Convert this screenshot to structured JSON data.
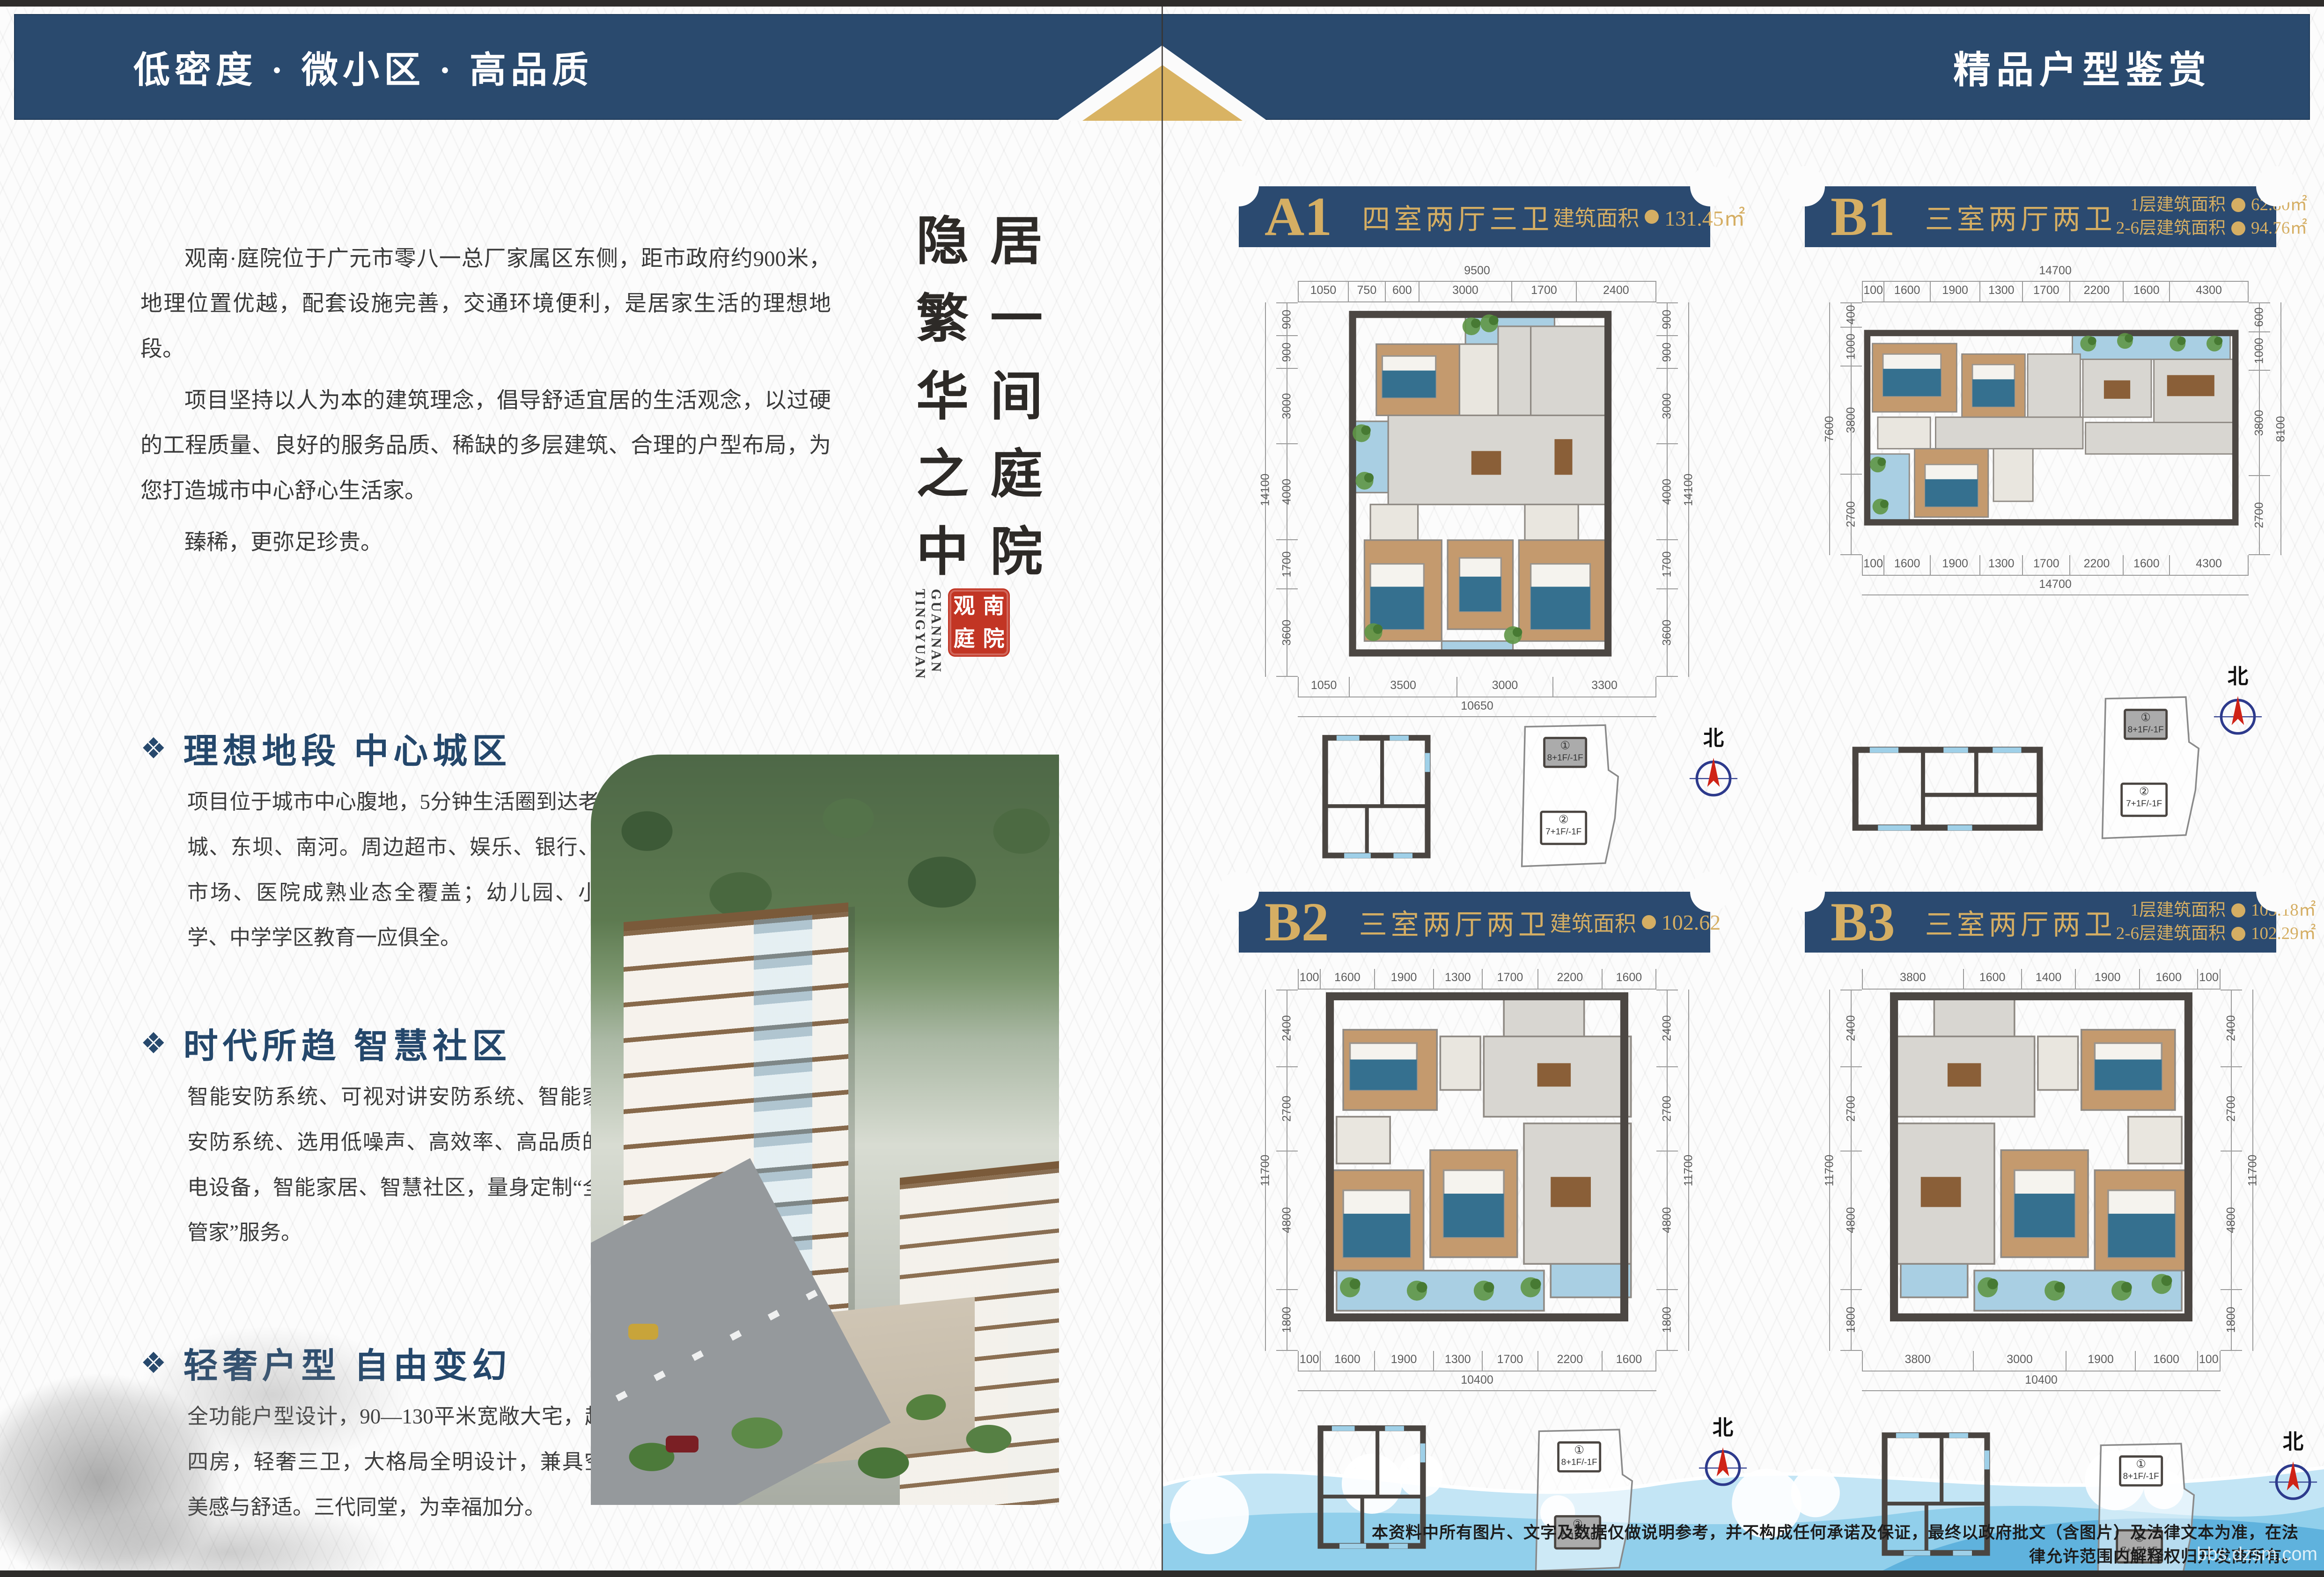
{
  "colors": {
    "band_navy": "#2a4a6e",
    "plate_navy": "#2b4a70",
    "gold": "#d5ae63",
    "title_navy": "#24476b",
    "seal_red": "#c23524",
    "wave_blue": "#8ecdea"
  },
  "page_left": {
    "header_slogan": "低密度 · 微小区 · 高品质",
    "intro": {
      "p1": "观南·庭院位于广元市零八一总厂家属区东侧，距市政府约900米，地理位置优越，配套设施完善，交通环境便利，是居家生活的理想地段。",
      "p2": "项目坚持以人为本的建筑理念，倡导舒适宜居的生活观念，以过硬的工程质量、良好的服务品质、稀缺的多层建筑、合理的户型布局，为您打造城市中心舒心生活家。",
      "p3": "臻稀，更弥足珍贵。"
    },
    "calligraphy": {
      "col_right": "居一间庭院",
      "col_left": "隐繁华之中",
      "latin_1": "GUANNAN",
      "latin_2": "TINGYUAN",
      "seal_chars": [
        "观",
        "南",
        "庭",
        "院"
      ]
    },
    "sections": [
      {
        "title": "理想地段 中心城区",
        "body": "项目位于城市中心腹地，5分钟生活圈到达老城、东坝、南河。周边超市、娱乐、银行、市场、医院成熟业态全覆盖；幼儿园、小学、中学学区教育一应俱全。"
      },
      {
        "title": "时代所趋 智慧社区",
        "body": "智能安防系统、可视对讲安防系统、智能家居安防系统、选用低噪声、高效率、高品质的机电设备，智能家居、智慧社区，量身定制“全能管家”服务。"
      },
      {
        "title": "轻奢户型 自由变幻",
        "body": "全功能户型设计，90—130平米宽敞大宅，超阔四房，轻奢三卫，大格局全明设计，兼具空间美感与舒适。三代同堂，为幸福加分。"
      }
    ]
  },
  "page_right": {
    "header_title": "精品户型鉴赏",
    "north_label": "北",
    "site_buildings": [
      {
        "num": "①",
        "floors": "8+1F/-1F"
      },
      {
        "num": "②",
        "floors": "7+1F/-1F"
      }
    ],
    "plans": [
      {
        "id": "A1",
        "code": "A1",
        "type": "四室两厅三卫",
        "areas": [
          {
            "label": "建筑面积",
            "value": "131.45㎡"
          }
        ],
        "dims": {
          "top_total": "9500",
          "top_segs": [
            "1050",
            "750",
            "600",
            "3000",
            "1700",
            "2400"
          ],
          "bottom_segs": [
            "1050",
            "3500",
            "3000",
            "3300"
          ],
          "bottom_total": "10650",
          "left_total": "14100",
          "left_segs": [
            "900",
            "900",
            "3000",
            "4000",
            "1700",
            "3600"
          ],
          "right_segs": [
            "900",
            "900",
            "3000",
            "4000",
            "1700",
            "3600"
          ],
          "right_total": "14100"
        },
        "site_highlight": 0
      },
      {
        "id": "B1",
        "code": "B1",
        "type": "三室两厅两卫",
        "areas": [
          {
            "label": "1层建筑面积",
            "value": "62.80㎡"
          },
          {
            "label": "2-6层建筑面积",
            "value": "94.76㎡"
          }
        ],
        "dims": {
          "top_total": "14700",
          "top_segs": [
            "100",
            "1600",
            "1900",
            "1300",
            "1700",
            "2200",
            "1600",
            "4300"
          ],
          "bottom_segs": [
            "100",
            "1600",
            "1900",
            "1300",
            "1700",
            "2200",
            "1600",
            "4300"
          ],
          "bottom_total": "14700",
          "left_total": "7600",
          "left_segs": [
            "400",
            "1000",
            "3800",
            "2700"
          ],
          "right_segs": [
            "600",
            "1000",
            "3800",
            "2700"
          ],
          "right_total": "8100"
        },
        "site_highlight": 0
      },
      {
        "id": "B2",
        "code": "B2",
        "type": "三室两厅两卫",
        "areas": [
          {
            "label": "建筑面积",
            "value": "102.62"
          }
        ],
        "dims": {
          "top_segs": [
            "100",
            "1600",
            "1900",
            "1300",
            "1700",
            "2200",
            "1600"
          ],
          "bottom_segs": [
            "100",
            "1600",
            "1900",
            "1300",
            "1700",
            "2200",
            "1600"
          ],
          "bottom_total": "10400",
          "left_total": "11700",
          "left_segs": [
            "2400",
            "2700",
            "4800",
            "1800"
          ],
          "right_segs": [
            "2400",
            "2700",
            "4800",
            "1800"
          ],
          "right_total": "11700"
        },
        "site_highlight": 1
      },
      {
        "id": "B3",
        "code": "B3",
        "type": "三室两厅两卫",
        "areas": [
          {
            "label": "1层建筑面积",
            "value": "105.18㎡"
          },
          {
            "label": "2-6层建筑面积",
            "value": "102.29㎡"
          }
        ],
        "dims": {
          "top_segs": [
            "3800",
            "1600",
            "1400",
            "1900",
            "1600",
            "100"
          ],
          "bottom_segs": [
            "3800",
            "3000",
            "1900",
            "1600",
            "100"
          ],
          "bottom_total": "10400",
          "left_total": "11700",
          "left_segs": [
            "2400",
            "2700",
            "4800",
            "1800"
          ],
          "right_segs": [
            "2400",
            "2700",
            "4800",
            "1800"
          ],
          "right_total": "11700"
        },
        "site_highlight": 1
      }
    ],
    "disclaimer": "本资料中所有图片、文字及数据仅做说明参考，并不构成任何承诺及保证，最终以政府批文（含图片）及法律文本为准，在法律允许范围内解释权归开发商所有。",
    "watermark": "bbs.dzsm.com"
  }
}
